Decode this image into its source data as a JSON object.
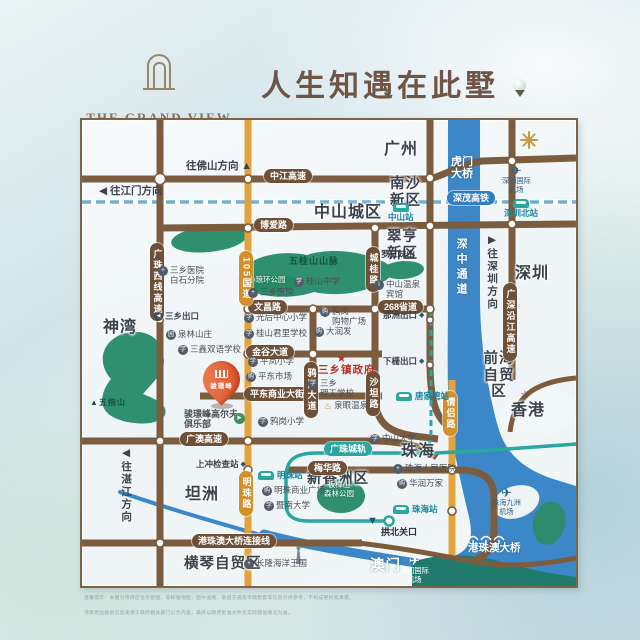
{
  "colors": {
    "road_brown": "#7b5c3e",
    "road_brown_d": "#6d5037",
    "road_orange": "#e3a33c",
    "road_orange_d": "#d28f2a",
    "rail_teal": "#2aa7a0",
    "water": "#3c87c8",
    "green": "#2f9070",
    "accent_red": "#cf3227"
  },
  "header": {
    "brand_en": "THE GRAND VIEW",
    "brand_tagline": "Landing On Your Golf Paradise",
    "brand_cn": "骏璟峰",
    "slogan": "人生知遇在此墅"
  },
  "icons": {
    "star": "★",
    "star_outline": "☆",
    "plane": "✈",
    "gate": "▼",
    "diamond": "◆",
    "hotspring": "♨",
    "flag": "▶",
    "mountain": "▲",
    "exit_left": "◀",
    "hospital": "+",
    "school": "学",
    "shop": "购",
    "info": "i",
    "park": "园",
    "university": "学",
    "attraction": "+"
  },
  "map": {
    "regions": {
      "guangzhou": "广州",
      "nansha": "南沙新区",
      "zhongshan_city": "中山城区",
      "cuiheng": "翠亨新区",
      "shenzhen": "深圳",
      "shenwan": "神湾",
      "qianhai": "前海\n自贸区",
      "hongkong": "香港",
      "zhuhai": "珠海",
      "xinxiangzhou": "新香洲区",
      "tanzhou": "坦洲",
      "hengqin": "横琴自贸区",
      "macau": "澳门",
      "hzmb": "港珠澳大桥"
    },
    "directions": {
      "foshan": "往佛山方向 ▲",
      "jiangmen": "◀ 往江门方向",
      "shenzhen": "▶往深圳方向",
      "zhanjiang": "◀往湛江方向"
    },
    "roads": {
      "zhongjiang": "中江高速",
      "boai": "博爱路",
      "wenchang": "文昌路",
      "s268": "268省道",
      "jingu": "金谷大道",
      "pingdong": "平东商业大街",
      "guangao": "广澳高速",
      "hzmb_link": "港珠澳大桥连接线",
      "gzx": "广珠西线高速",
      "g105": "105国道",
      "chenggui": "城桂路",
      "yagang": "鸦岗大道",
      "shatan": "沙坦路",
      "mingzhu": "明珠路",
      "qinglv": "情侣路",
      "gsyj": "广深沿江高速",
      "meihua": "梅华路"
    },
    "rails": {
      "szmao": "深茂高铁",
      "gzcg": "广珠城轨"
    },
    "water_labels": {
      "szz_corridor": "深中通道",
      "humen": "虎门\n大桥"
    },
    "stations": {
      "zhongshan": "中山站",
      "shenzhen_north": "深圳北站",
      "tangjiawan": "唐家湾站",
      "mingzhu": "明珠站",
      "zhuhai": "珠海站"
    },
    "airports": {
      "shenzhen": "深圳国际\n机场",
      "jiuzhou": "珠海九洲\n机场",
      "macau": "澳门国际\n机场"
    },
    "mountains": {
      "wuguishan": "五桂山山脉",
      "luosanmei": "罗三妹山",
      "xiaolanghuan": "小琅环公园",
      "wuzhishan": "▲五指山",
      "banzhangshan": "板樟山\n森林公园"
    },
    "pois": {
      "hospital_baishi": "三乡医院\n白石分院",
      "hospital_sanxiang": "三乡医院",
      "guishan_school": "桂山中学",
      "guanghou_school": "光后中心小学",
      "junli_school": "桂山君里学校",
      "sanxin_school": "三鑫双语学校",
      "quanlin": "泉林山庄",
      "yagang_mall": "鸦岗\n购物广场",
      "rtmart": "大润发",
      "pinglan_school": "平岚小学",
      "pingdong_market": "平东市场",
      "yagang_school": "鸦岗小学",
      "gov": "三乡镇政府",
      "ligong_school": "三乡\n理工学校",
      "quanyan": "泉眼温泉",
      "wenquan_hotel": "中山温泉\n宾馆",
      "mingzhu_mall": "明珠商业广场",
      "jinan_univ": "暨南大学",
      "zhuhai_hospital": "珠海人民医院",
      "huarun": "华润万家",
      "zhongshan_univ": "中山大学",
      "gongbei": "拱北关口",
      "changlong": "长隆海洋王国"
    },
    "exits": {
      "sanxiang": "三乡出口",
      "nazhou": "那洲出口",
      "xiazha": "下栅出口",
      "shangchong": "上冲检查站"
    },
    "project": {
      "pin": "骏璟峰",
      "club": "骏璟峰高尔夫\n俱乐部"
    },
    "disclaimer": {
      "line1": "温馨提示：本图为项目区位示意图，非标准地图，图中道路、轨道交通及市政配套等信息仅供参考，不构成要约或承诺。",
      "line2": "项目周边规划信息来源于政府相关部门公示内容，最终以政府批准文件及实际建设情况为准。"
    }
  }
}
